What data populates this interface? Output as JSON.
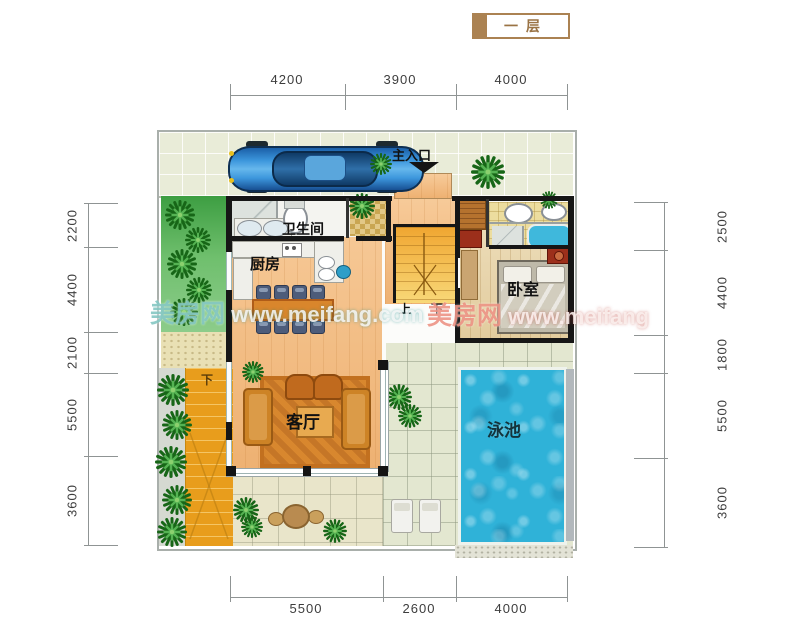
{
  "floor_tag": {
    "label": "一层"
  },
  "dimensions": {
    "top": [
      "4200",
      "3900",
      "4000"
    ],
    "bottom": [
      "5500",
      "2600",
      "4000"
    ],
    "left": [
      "2200",
      "4400",
      "2100",
      "5500",
      "3600"
    ],
    "right": [
      "2500",
      "4400",
      "1800",
      "5500",
      "3600"
    ]
  },
  "rooms": {
    "main_entrance": "主入口",
    "bathroom": "卫生间",
    "kitchen": "厨房",
    "living_room": "客厅",
    "bedroom": "卧室",
    "pool": "泳池",
    "stair_up": "上",
    "stair_down": "下",
    "garden_stair_down": "下"
  },
  "watermarks": [
    {
      "brand": "美房网",
      "url": " www.meifang.com"
    },
    {
      "brand": "美房网",
      "url": " www.meifang"
    }
  ],
  "colors": {
    "tag_tan": "#ab8252",
    "pool_blue": "#2fb2d8",
    "wood_orange": "#f2bd85",
    "garden_green": "#4aa54a",
    "stair_orange": "#e89d1c",
    "wall_black": "#161616"
  }
}
